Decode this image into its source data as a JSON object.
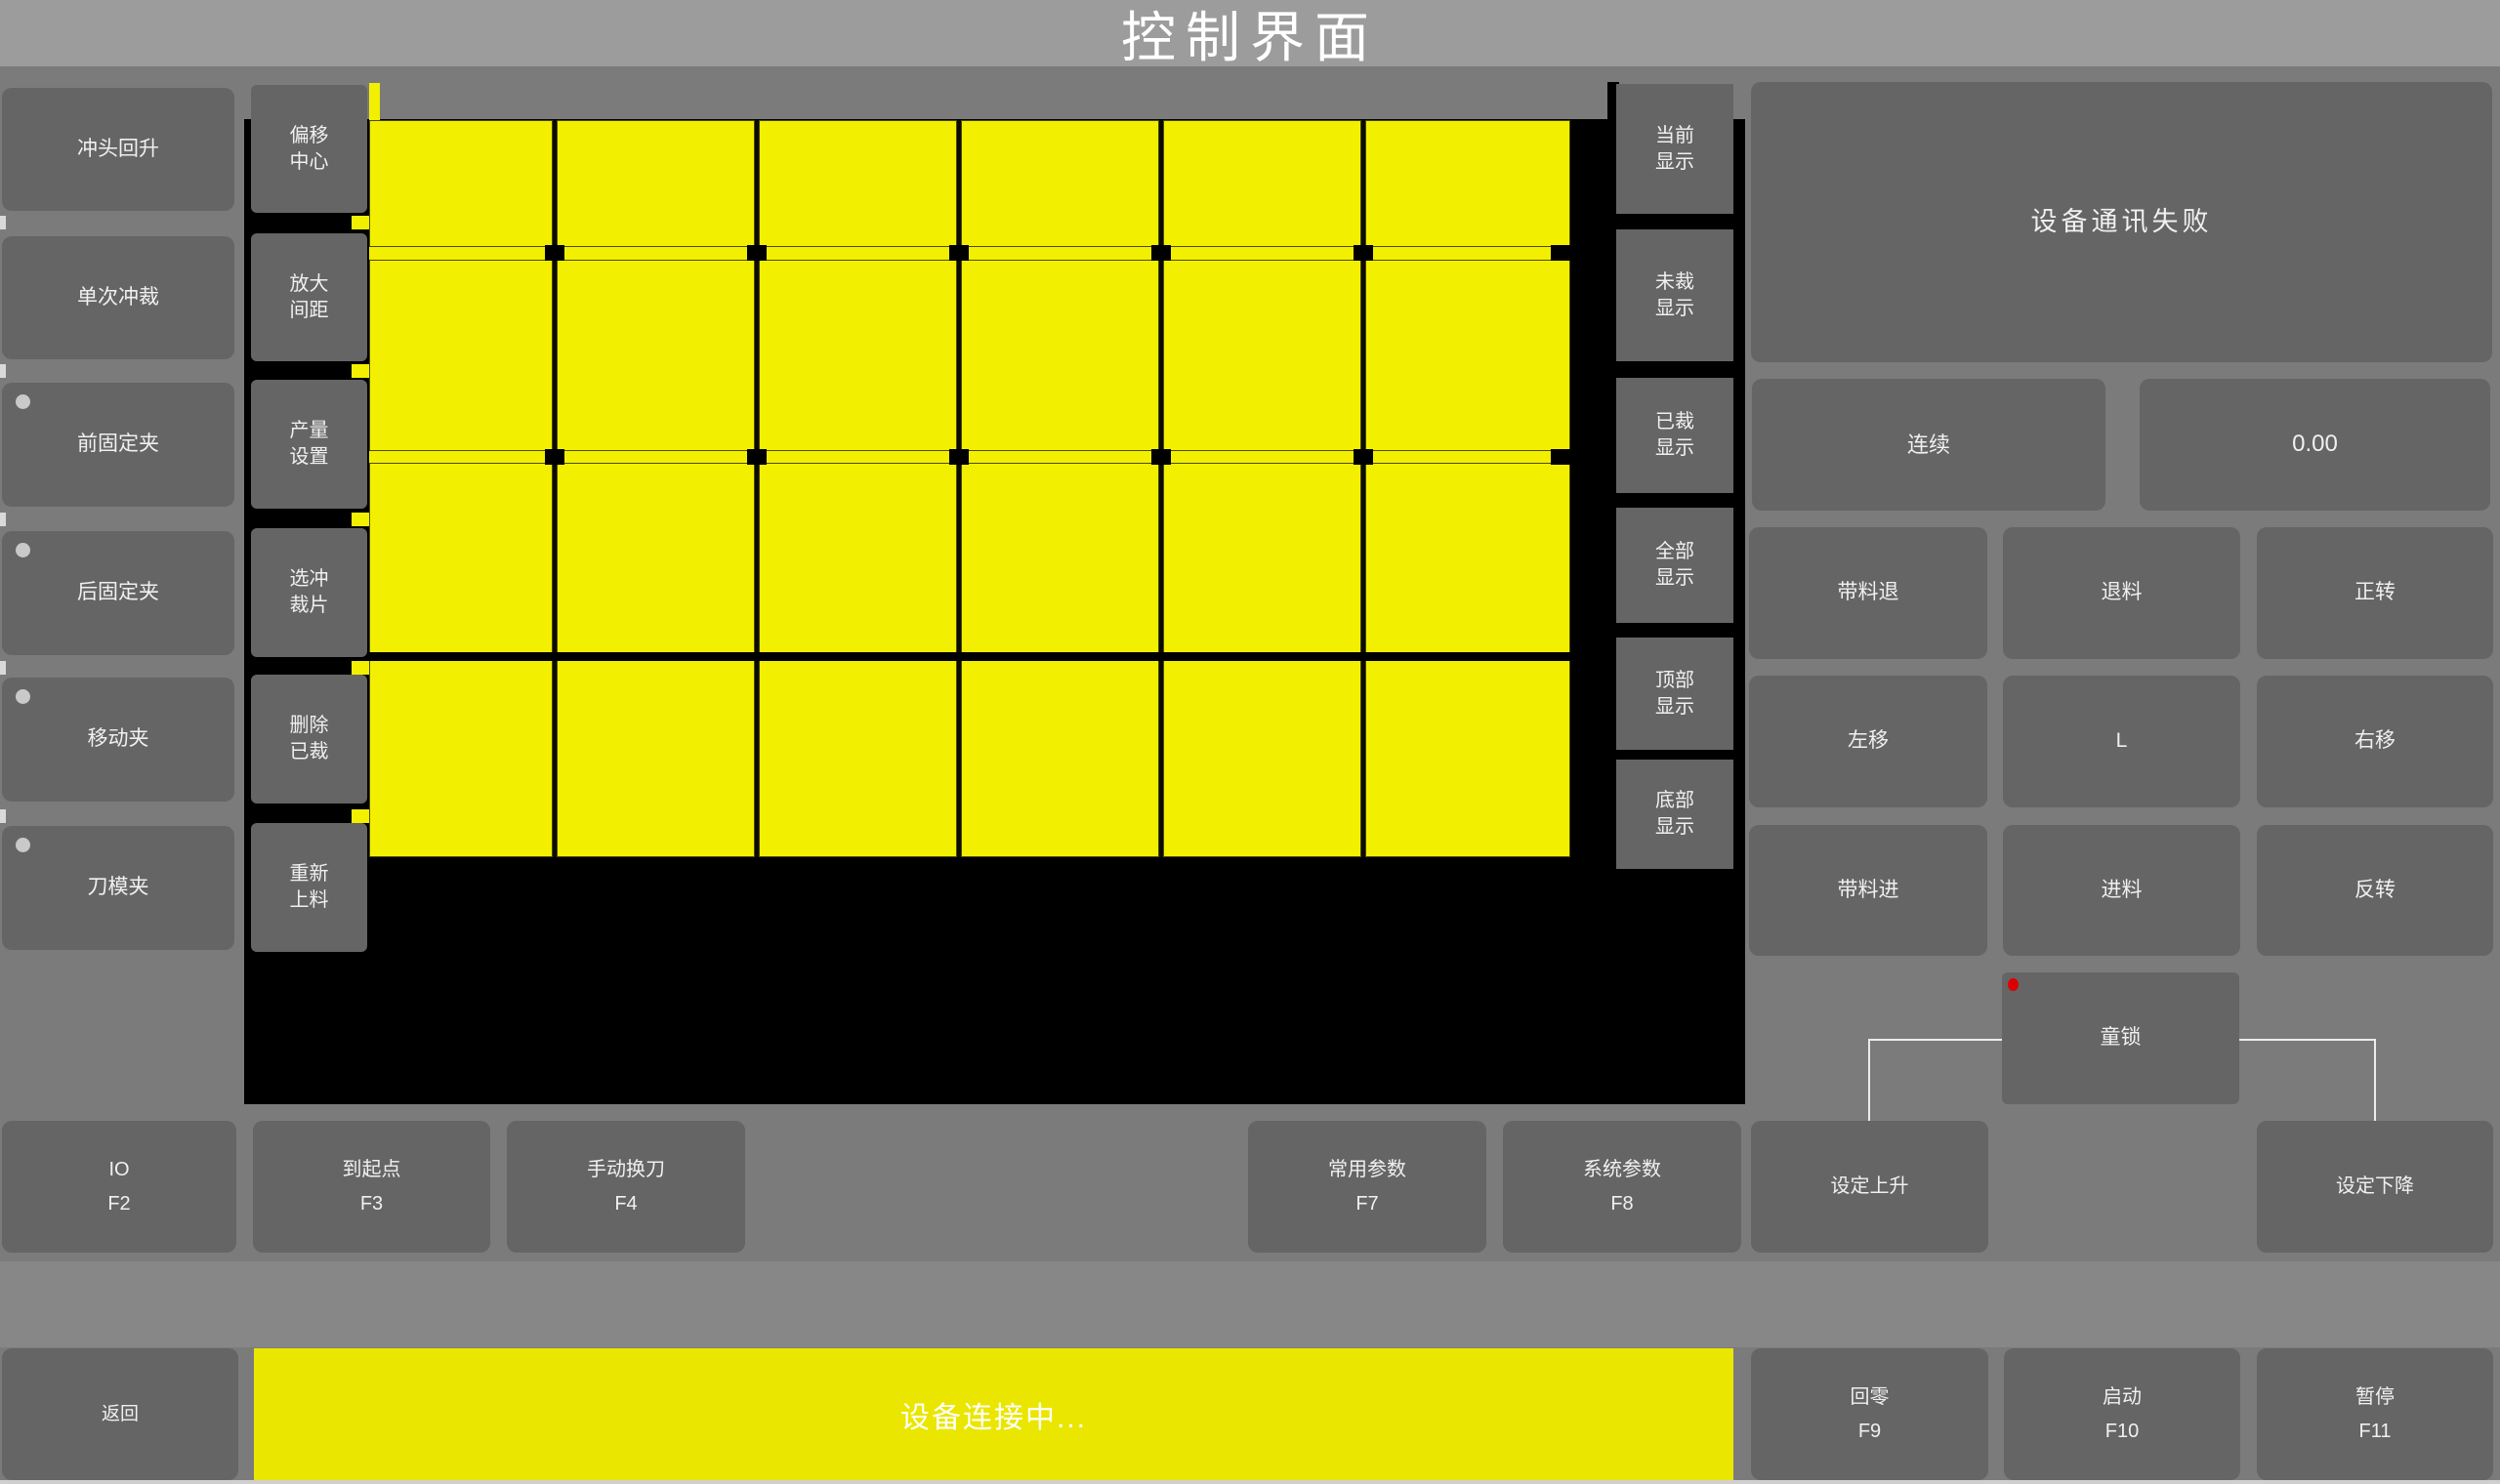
{
  "title_bar": {
    "title": "控制界面"
  },
  "colors": {
    "background": "#7b7b7b",
    "titlebar": "#9c9c9c",
    "button_gray": "#656565",
    "canvas_black": "#000000",
    "piece_yellow": "#f3ef00",
    "status_yellow": "#eae600",
    "indicator_red": "#dd0000",
    "bracket_white": "#ececec",
    "text_white": "#f0f0f0"
  },
  "left_buttons": [
    {
      "label": "冲头回升",
      "indicator": false
    },
    {
      "label": "单次冲裁",
      "indicator": false
    },
    {
      "label": "前固定夹",
      "indicator": true
    },
    {
      "label": "后固定夹",
      "indicator": true
    },
    {
      "label": "移动夹",
      "indicator": true
    },
    {
      "label": "刀模夹",
      "indicator": true
    }
  ],
  "tool_buttons": [
    {
      "label": "偏移\n中心"
    },
    {
      "label": "放大\n间距"
    },
    {
      "label": "产量\n设置"
    },
    {
      "label": "选冲\n裁片"
    },
    {
      "label": "删除\n已裁"
    },
    {
      "label": "重新\n上料"
    }
  ],
  "display_buttons": [
    {
      "label": "当前\n显示"
    },
    {
      "label": "未裁\n显示"
    },
    {
      "label": "已裁\n显示"
    },
    {
      "label": "全部\n显示"
    },
    {
      "label": "顶部\n显示"
    },
    {
      "label": "底部\n显示"
    }
  ],
  "nest_canvas": {
    "piece_rows": 4,
    "piece_columns": 6,
    "piece_color": "#f3ef00",
    "background": "#000000"
  },
  "right_panel": {
    "message": "设备通讯失败",
    "mode_button": "连续",
    "value_display": "0.00",
    "jog_buttons": [
      "带料退",
      "退料",
      "正转",
      "左移",
      "L",
      "右移",
      "带料进",
      "进料",
      "反转"
    ],
    "child_lock": "童锁"
  },
  "function_row": [
    {
      "label": "IO",
      "key": "F2"
    },
    {
      "label": "到起点",
      "key": "F3"
    },
    {
      "label": "手动换刀",
      "key": "F4"
    },
    {
      "label": "常用参数",
      "key": "F7"
    },
    {
      "label": "系统参数",
      "key": "F8"
    },
    {
      "label": "设定上升",
      "key": ""
    },
    {
      "label": "设定下降",
      "key": ""
    }
  ],
  "bottom_bar": {
    "back": "返回",
    "status": "设备连接中...",
    "keys": [
      {
        "label": "回零",
        "key": "F9"
      },
      {
        "label": "启动",
        "key": "F10"
      },
      {
        "label": "暂停",
        "key": "F11"
      }
    ]
  }
}
